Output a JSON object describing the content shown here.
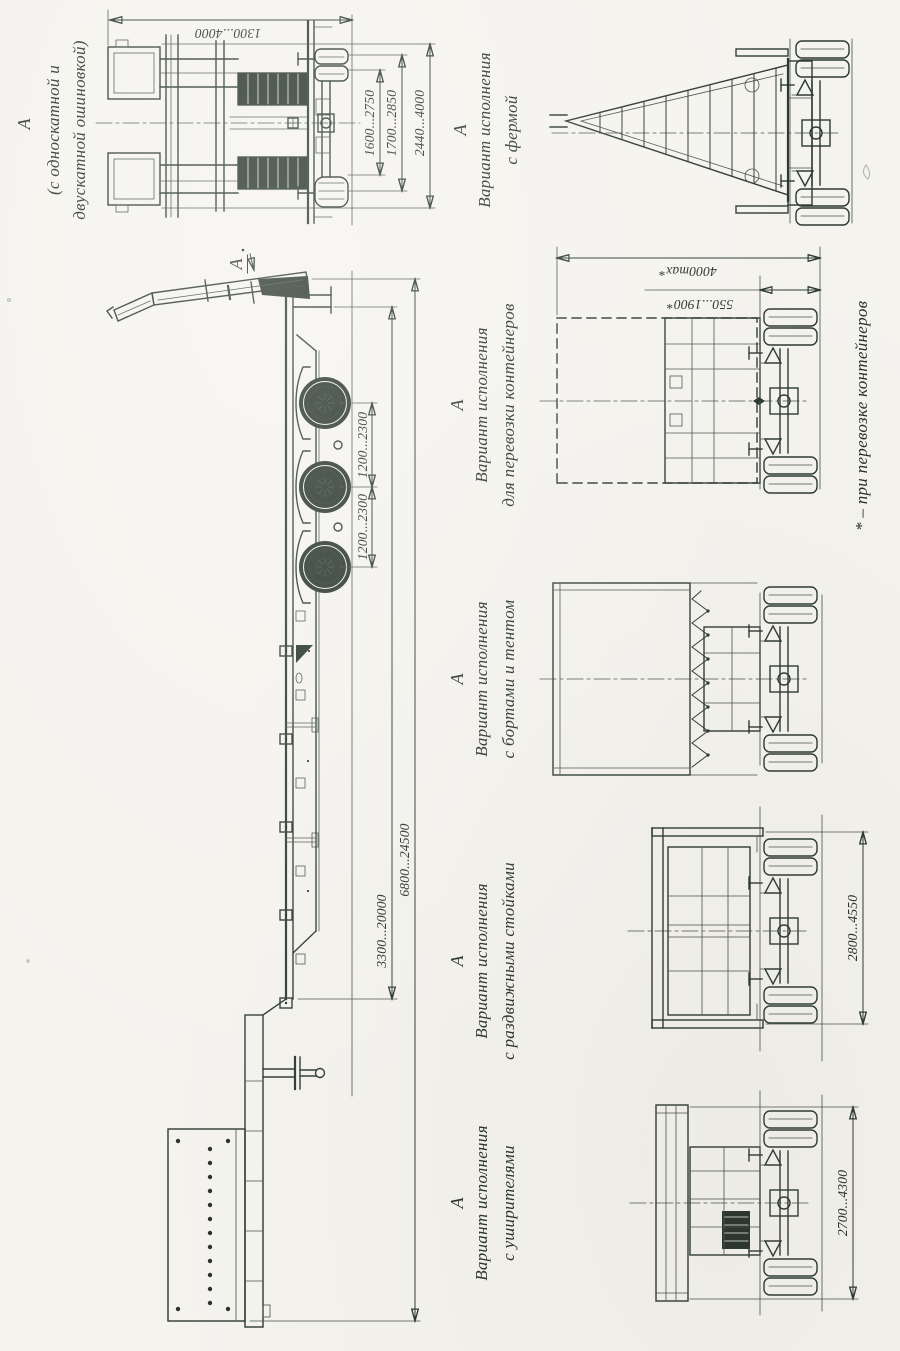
{
  "page": {
    "paper_color": "#f5f3ee",
    "ink_color": "#2c3932"
  },
  "side_view": {
    "section_mark": "А",
    "dim_axle_spacing_1": "1200...2300",
    "dim_axle_spacing_2": "1200...2300",
    "dim_platform_length": "3300...20000",
    "dim_overall_length": "6800...24500"
  },
  "rear_view": {
    "mark": "А",
    "subtitle_line1": "(с односкатной и",
    "subtitle_line2": "двускатной ошиновкой)",
    "dim_width_inner": "1600...2750",
    "dim_width_outer": "1700...2850",
    "dim_overall_width": "2440...4000",
    "dim_ramp_height": "1300...4000"
  },
  "variants": [
    {
      "mark": "А",
      "title": "Вариант исполнения",
      "name": "с уширителями",
      "dim_width": "2700...4300"
    },
    {
      "mark": "А",
      "title": "Вариант исполнения",
      "name": "с раздвижными стойками",
      "dim_width": "2800...4550"
    },
    {
      "mark": "А",
      "title": "Вариант исполнения",
      "name": "с бортами и тентом"
    },
    {
      "mark": "А",
      "title": "Вариант исполнения",
      "name": "для перевозки контейнеров",
      "dim_height_max": "4000max*",
      "dim_platform_height": "550...1900*"
    },
    {
      "mark": "А",
      "title": "Вариант исполнения",
      "name": "с фермой"
    }
  ],
  "footnote": "* – при перевозке контейнеров"
}
